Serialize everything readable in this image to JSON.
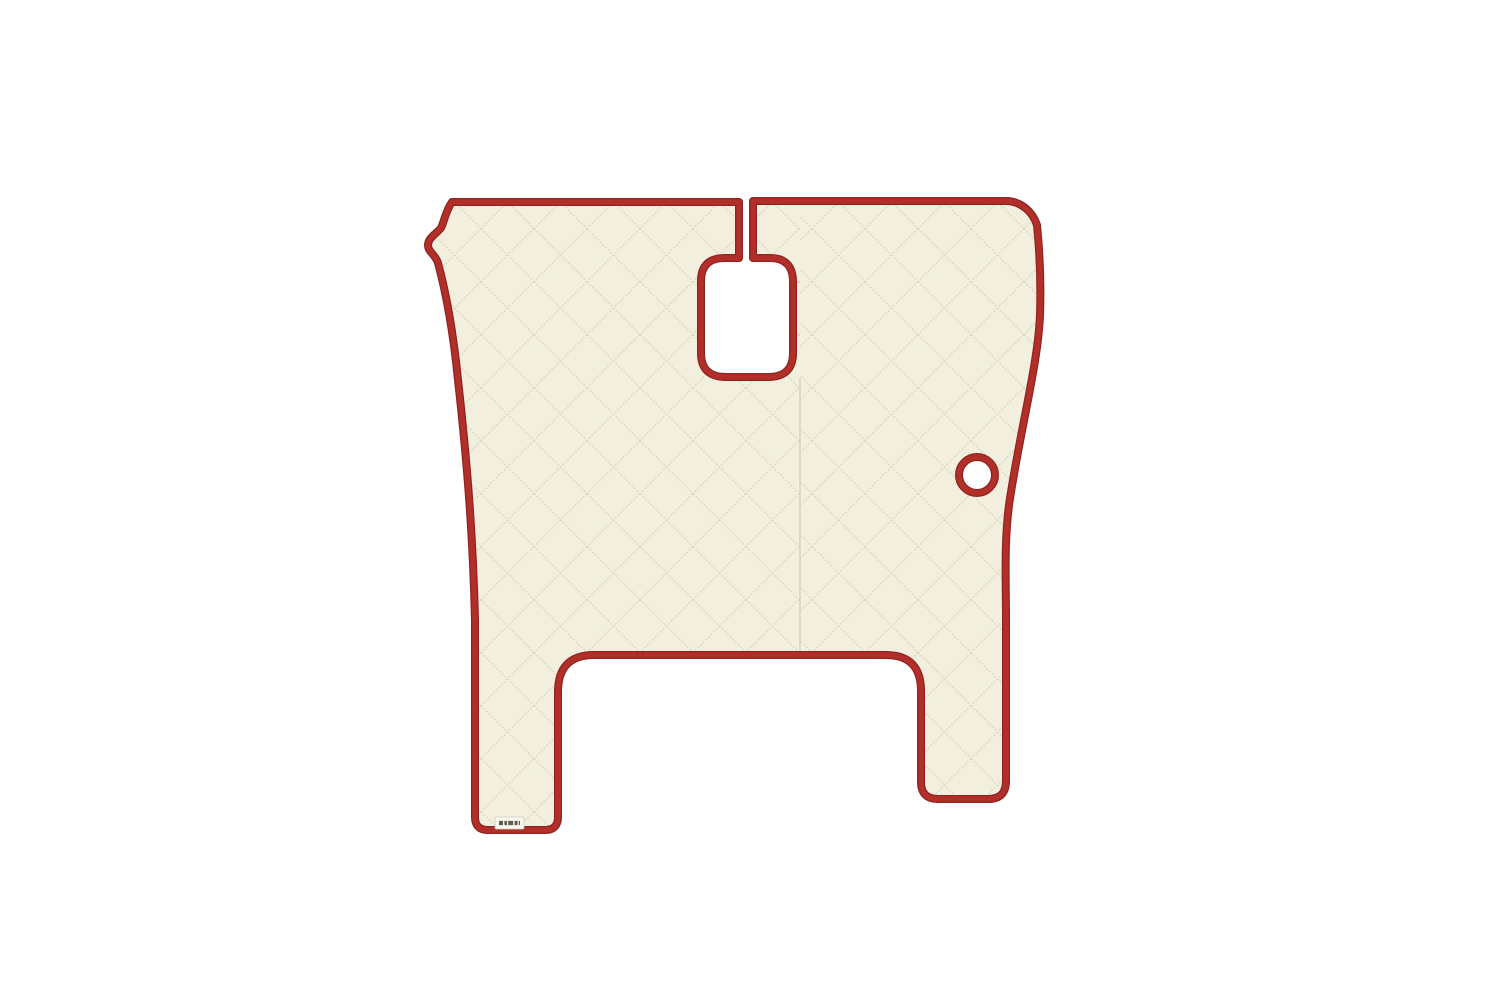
{
  "scene": {
    "description": "Product photo: quilted truck-cab floor mat cover in cream eco-leather with red piping trim, centered on a plain white background. The mat has a split at the top centre leading to a rounded rectangular gear-lever cutout, a small round cutout on the right side, a large squared cutout between two bottom legs, and a tiny sewn-in brand tag near the bottom of the left leg (text too small to read).",
    "background": "plain white"
  },
  "colors": {
    "background": "#ffffff",
    "mat": "#f2efde",
    "stitch": "#d9d5ba",
    "trim": "#b22e29",
    "trim_dark": "#8f2320",
    "seam": "#d8d4bb",
    "tag_bg": "#f9f8f0",
    "tag_border": "#cfccba",
    "tag_text": "#3f3c33"
  },
  "parts": {
    "mat": "quilted-floor-mat",
    "top_split": "top-centre-split",
    "gear_cutout": "gear-lever-cutout",
    "round_cutout": "round-cutout",
    "tunnel_cutout": "bottom-tunnel-cutout",
    "left_leg": "left-leg",
    "right_leg": "right-leg",
    "tag": "brand-tag"
  }
}
